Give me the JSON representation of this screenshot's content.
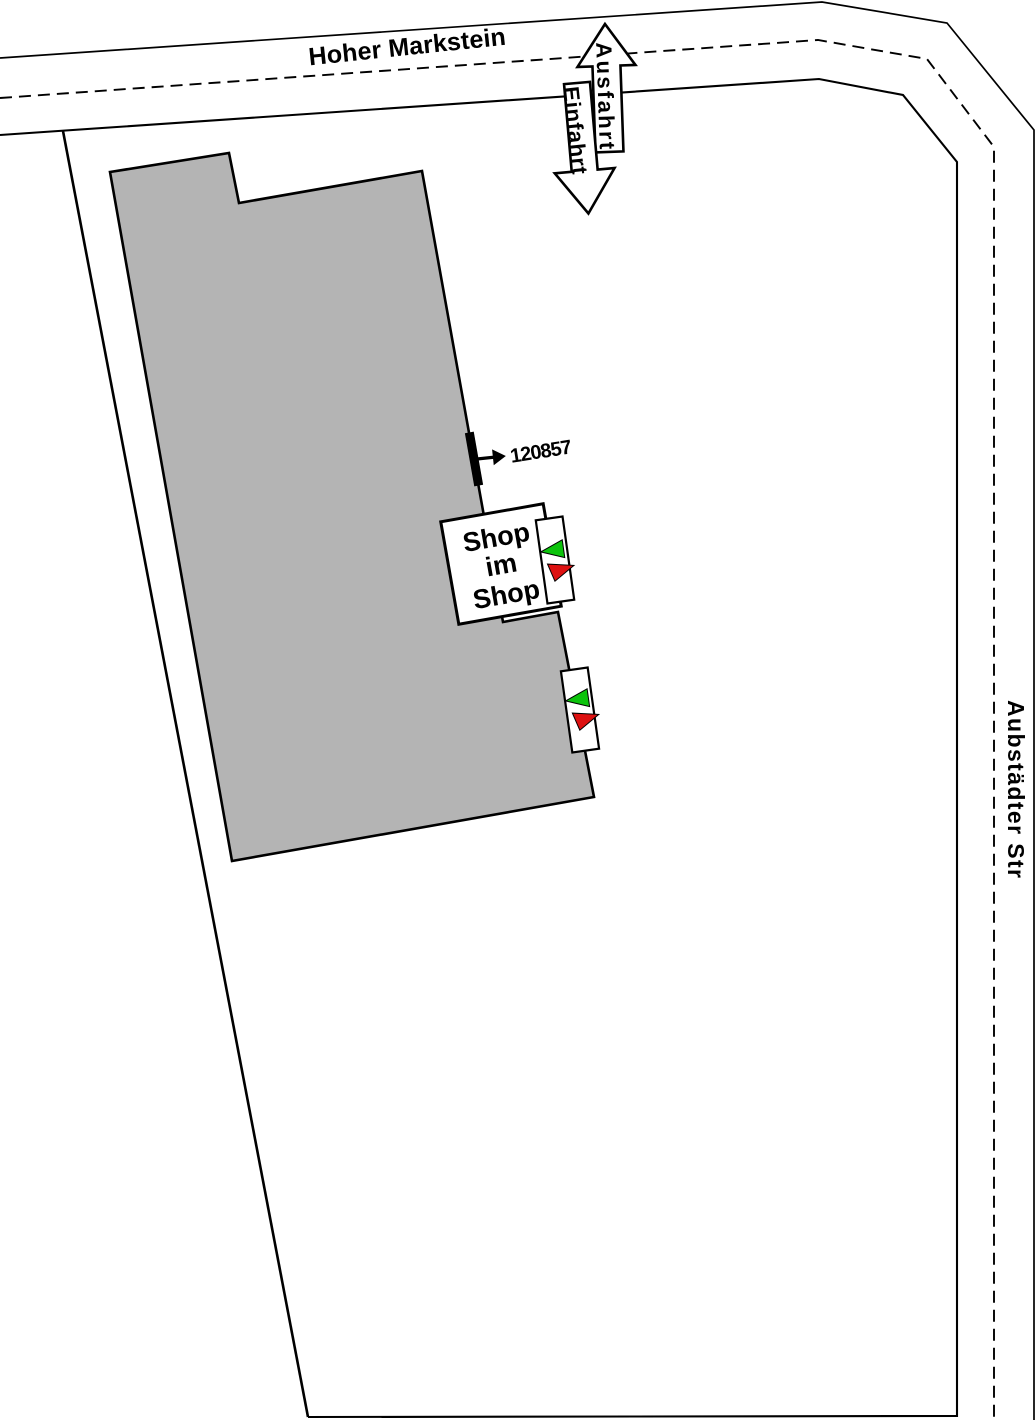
{
  "plan": {
    "streets": {
      "top_label": "Hoher Markstein",
      "right_label": "Aubstädter Str"
    },
    "access": {
      "exit_label": "Ausfahrt",
      "entrance_label": "Einfahrt"
    },
    "door": {
      "id_label": "120857"
    },
    "shop": {
      "lines": [
        "Shop",
        "im",
        "Shop"
      ]
    },
    "colors": {
      "building_fill": "#b4b4b4",
      "inbound_green": "#0cc30c",
      "outbound_red": "#dd1111",
      "line_black": "#000000",
      "marker_white": "#ffffff"
    }
  }
}
